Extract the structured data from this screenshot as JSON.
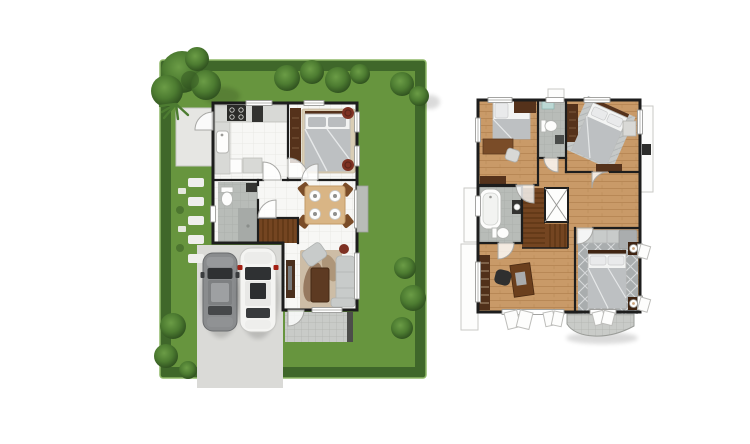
{
  "canvas": {
    "width": 750,
    "height": 444,
    "background": "#ffffff"
  },
  "colors": {
    "lawn": "#67953e",
    "hedge": "#3f672a",
    "hedge-edge": "#8fb968",
    "tree-light": "#6b9c46",
    "tree-mid": "#4d7c31",
    "tree-dark": "#2e4f1e",
    "concrete": "#dadad7",
    "concrete-light": "#e6e6e3",
    "floor": "#f7f7f5",
    "tile-line": "#e8e8e5",
    "wall": "#1d1d1d",
    "wood": "#c99a68",
    "wood-line": "#b3824f",
    "wood-dark": "#744521",
    "stair-line": "#54300f",
    "bath-tile": "#b8bcb8",
    "bath-line": "#a9ada9",
    "counter": "#d8d9d6",
    "furniture-dark": "#55321b",
    "furniture-brown": "#7a4c28",
    "table-wood": "#d9b585",
    "rug-beige": "#d9cdb4",
    "rug-gray": "#a9adae",
    "rug-lattice": "#d7d9da",
    "bed-duvet": "#bdc0c2",
    "pillow": "#e9eaeb",
    "sofa": "#c8cbca",
    "accent-red": "#7e3123",
    "car-dark-body": "#8a8c8e",
    "car-white-body": "#f4f4f2",
    "glass": "#2f3133",
    "balcony-tile": "#c9cbc8",
    "door-arc": "#a8a8a5",
    "window-frame": "#9b9b98",
    "shadow": "#000000"
  },
  "ground_floor": {
    "id": "ground-floor",
    "outdoor_features": [
      "garden-lawn",
      "hedge-border",
      "trees-and-shrubs",
      "stepping-stones",
      "terrace",
      "driveway",
      "patio-tiles"
    ],
    "rooms": [
      "kitchen",
      "bedroom",
      "bathroom",
      "hallway",
      "dining-area",
      "staircase",
      "living-room"
    ],
    "furniture": [
      "kitchen-counter",
      "stove",
      "sink",
      "wardrobe",
      "double-bed",
      "poufs",
      "toilet",
      "dining-table",
      "dining-chairs",
      "plates",
      "sofa",
      "armchair",
      "coffee-table",
      "tv-console",
      "rugs"
    ],
    "vehicles": [
      "dark-sedan",
      "white-car"
    ]
  },
  "upper_floor": {
    "id": "upper-floor",
    "rooms": [
      "bedroom-2",
      "bathroom-2",
      "bedroom-3",
      "hallway",
      "bathroom-3",
      "staircase",
      "stair-void",
      "family-area",
      "master-bedroom"
    ],
    "outdoor_features": [
      "rear-balcony",
      "side-ledges",
      "air-conditioner-unit"
    ],
    "furniture": [
      "single-bed",
      "study-desk",
      "desk-chair",
      "wardrobes",
      "dressers",
      "toilets",
      "wash-basin",
      "bathtub",
      "diagonal-bed",
      "area-rugs",
      "master-bed",
      "nightstands",
      "table-lamps",
      "bench-sofa",
      "bookshelf",
      "work-desk",
      "office-chair"
    ]
  }
}
